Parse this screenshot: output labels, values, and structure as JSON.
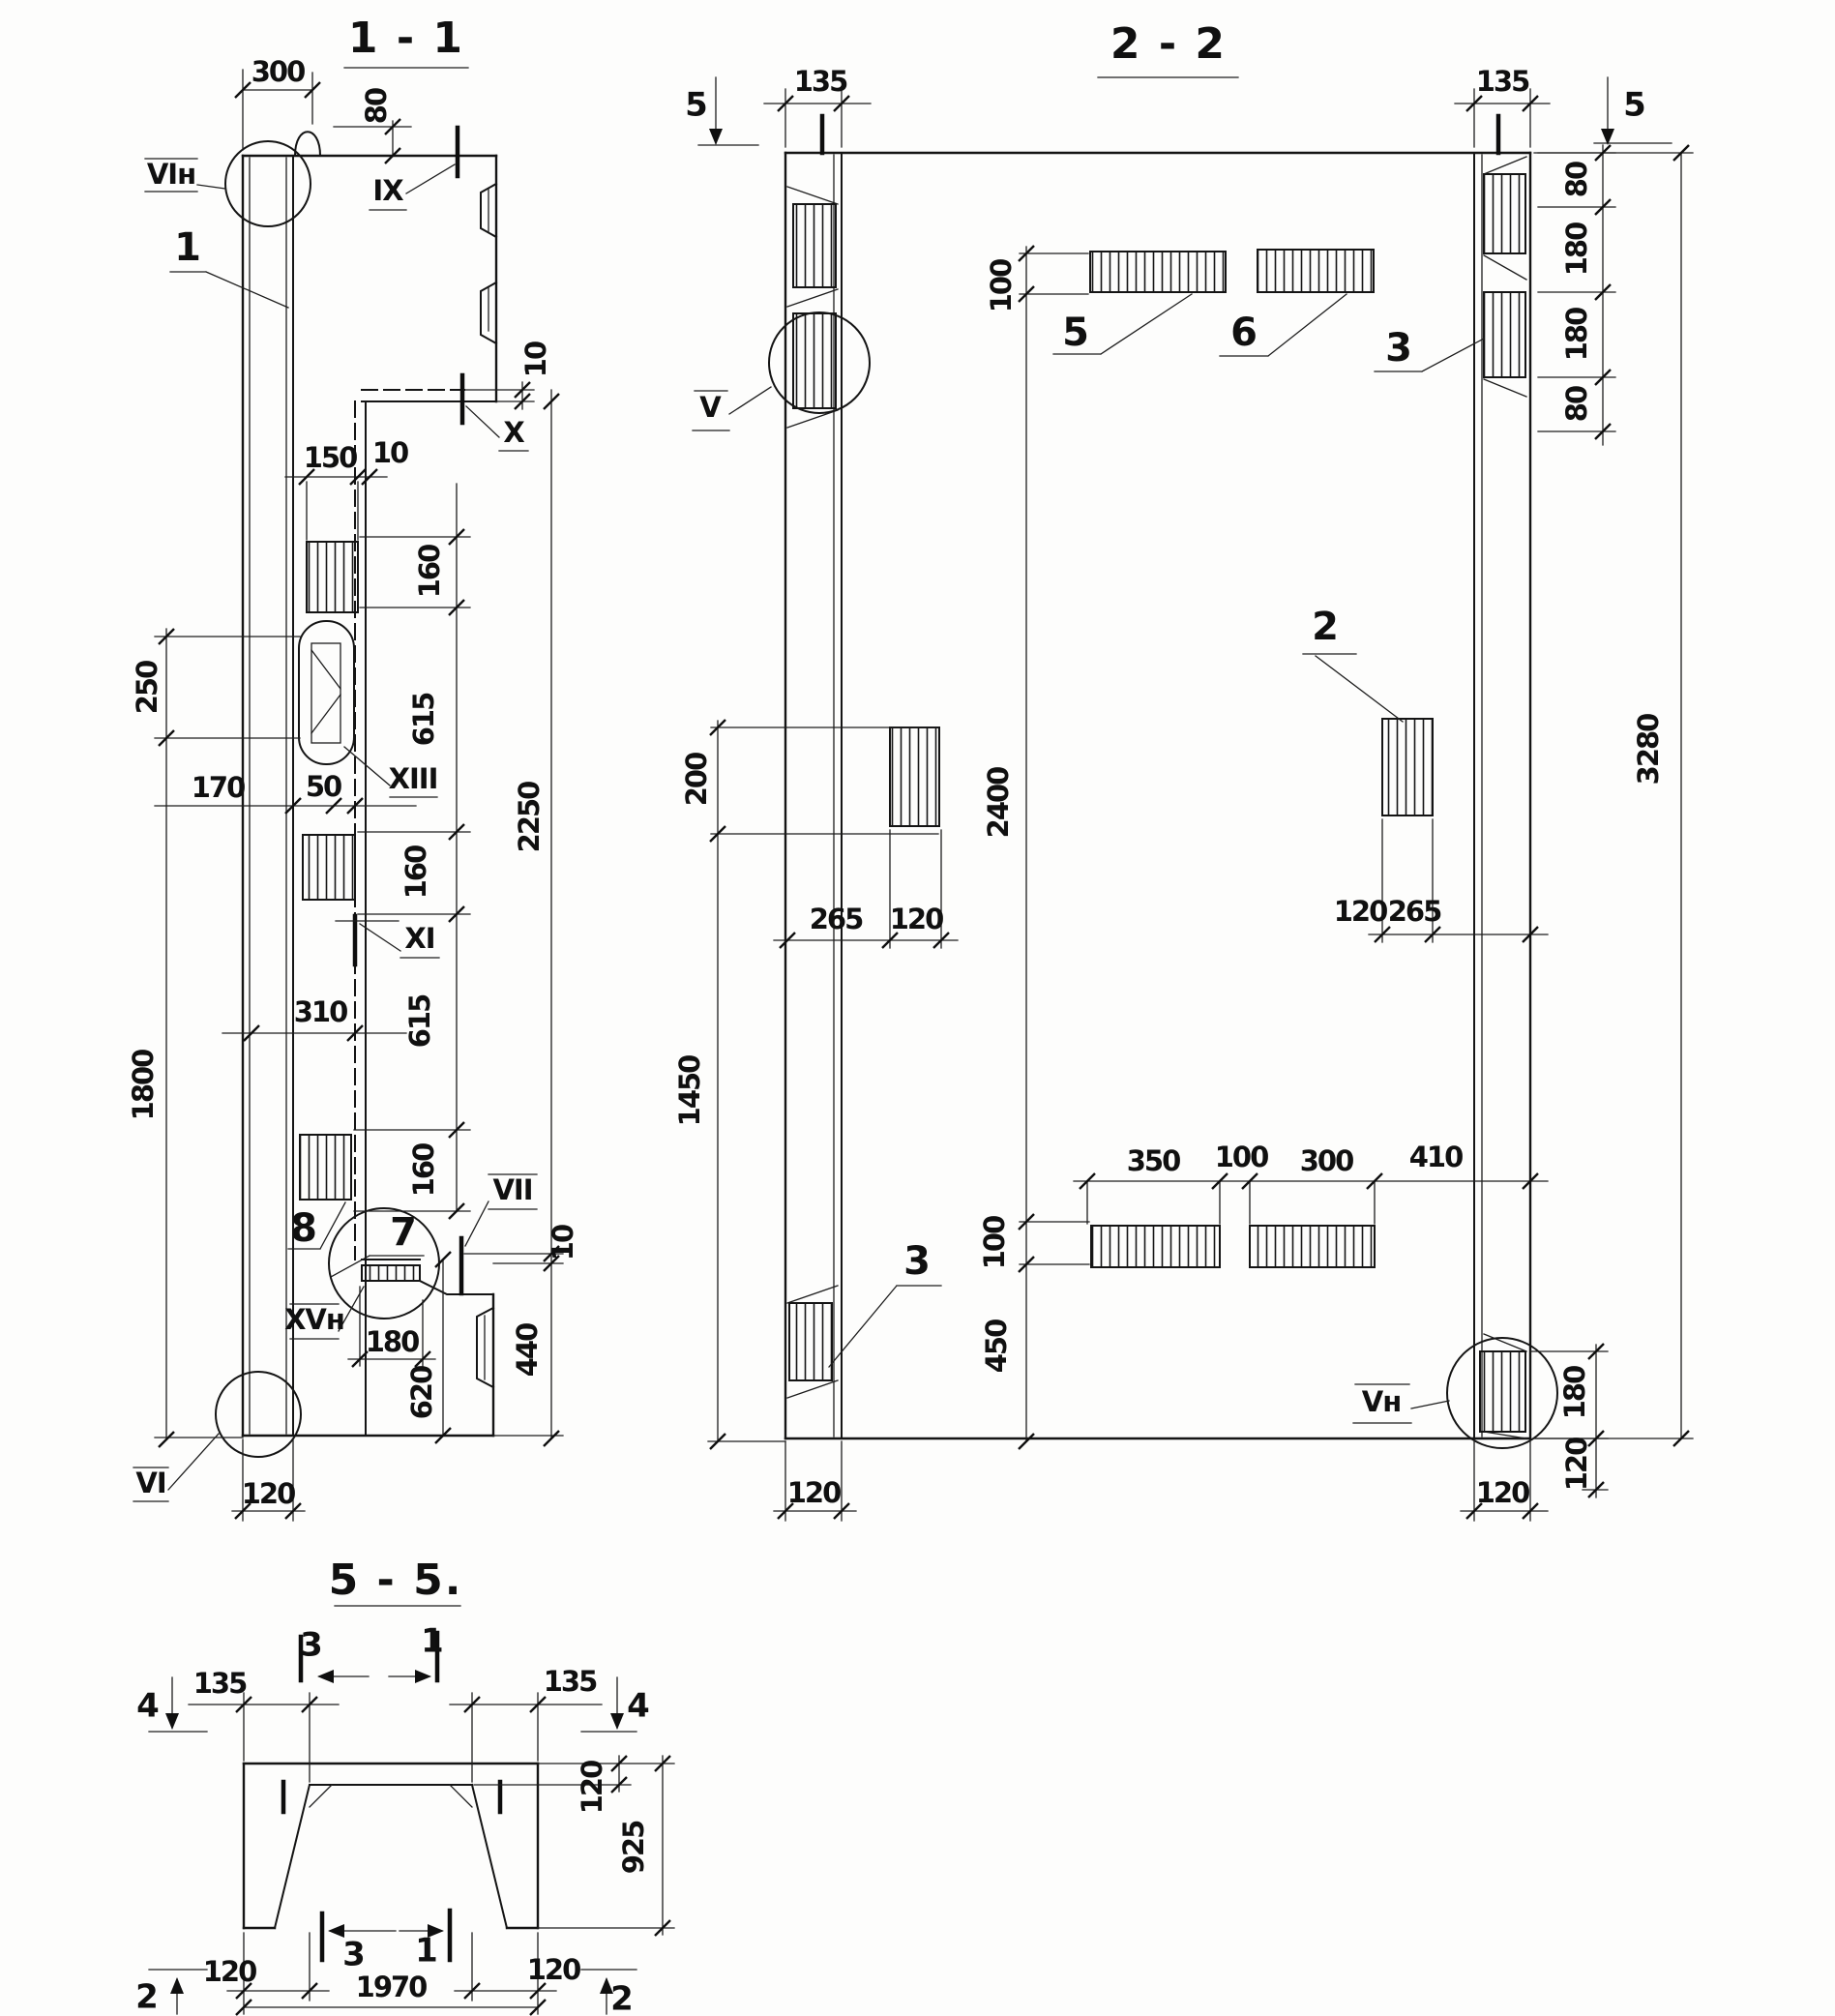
{
  "s11": {
    "title": "1 - 1",
    "marks": {
      "vin": "VIн",
      "ix": "IX",
      "x": "X",
      "xi": "XI",
      "xiii": "XIII",
      "vii": "VII",
      "xvn": "XVн",
      "vi": "VI"
    },
    "poz": {
      "p1": "1",
      "p7": "7",
      "p8": "8"
    },
    "dims": {
      "d300": "300",
      "d80": "80",
      "d10step": "10",
      "d150": "150",
      "d10b": "10",
      "d160a": "160",
      "d615a": "615",
      "d160b": "160",
      "d615b": "615",
      "d160c": "160",
      "d2250": "2250",
      "d10c": "10",
      "d440": "440",
      "d620": "620",
      "d180": "180",
      "d250": "250",
      "d1800": "1800",
      "d170": "170",
      "d50": "50",
      "d310": "310",
      "d120": "120"
    }
  },
  "s22": {
    "title": "2 - 2",
    "marks": {
      "v": "V",
      "vn": "Vн"
    },
    "cuts": {
      "c5l": "5",
      "c5r": "5"
    },
    "poz": {
      "p5": "5",
      "p6": "6",
      "p3r": "3",
      "p2": "2",
      "p3l": "3"
    },
    "dims": {
      "d135l": "135",
      "d135r": "135",
      "d80a": "80",
      "d180a": "180",
      "d180b": "180",
      "d80b": "80",
      "d3280": "3280",
      "d200": "200",
      "d1450": "1450",
      "d100t": "100",
      "d2400": "2400",
      "d100b": "100",
      "d450": "450",
      "d265l": "265",
      "d120l": "120",
      "d120r": "120",
      "d265r": "265",
      "d350": "350",
      "d100m": "100",
      "d300": "300",
      "d410": "410",
      "d120bl": "120",
      "d120br": "120",
      "d180r": "180",
      "d120rr": "120"
    }
  },
  "s55": {
    "title": "5 - 5.",
    "cuts": {
      "c3t": "3",
      "c1t": "1",
      "c3b": "3",
      "c1b": "1",
      "c4l": "4",
      "c4r": "4",
      "c2l": "2",
      "c2r": "2"
    },
    "dims": {
      "d135l": "135",
      "d135r": "135",
      "d120s": "120",
      "d925": "925",
      "d120bl": "120",
      "d120br": "120",
      "d1970": "1970"
    }
  }
}
